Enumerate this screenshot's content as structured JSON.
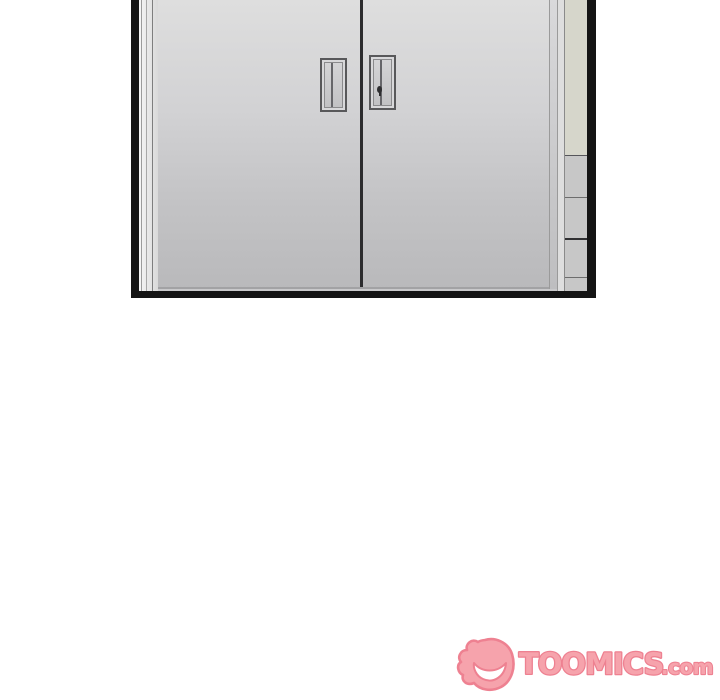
{
  "scene": {
    "panel_subject": "closed-double-metal-doors",
    "colors": {
      "panel_frame": "#141414",
      "door_gradient_top": "#dedede",
      "door_gradient_bottom": "#b9b9bb",
      "door_seam": "#2c2c2e",
      "side_column_tint": "#d6d6cb",
      "handle_frame": "#58585a"
    }
  },
  "watermark": {
    "brand": "TOOMICS",
    "suffix": ".com",
    "fill_color": "#F6A3AC",
    "outline_color": "#EE8191"
  }
}
